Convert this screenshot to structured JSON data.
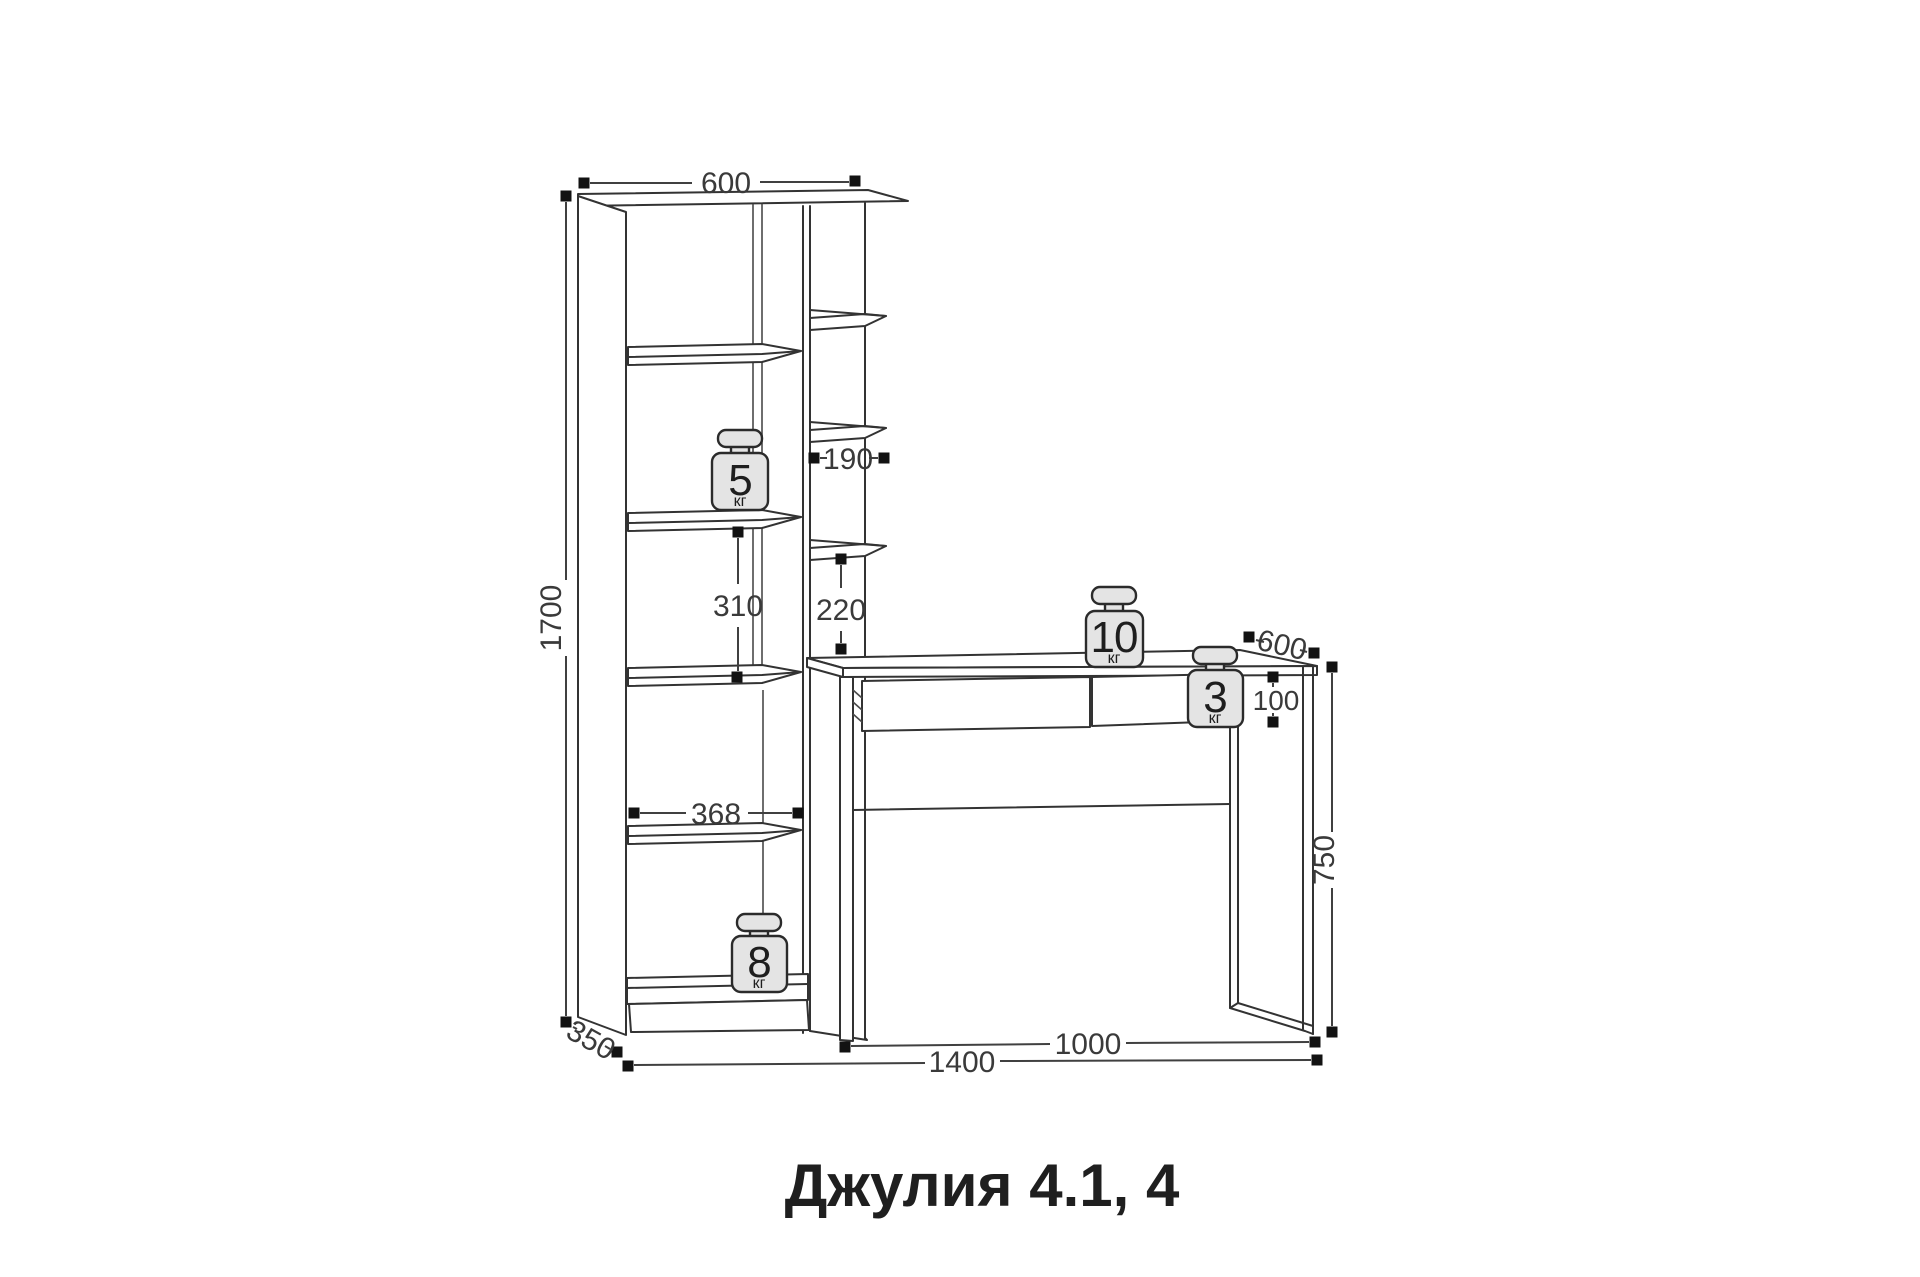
{
  "title": "Джулия 4.1, 4",
  "units": "мм",
  "dims": {
    "top_width": "600",
    "total_height": "1700",
    "column_inner_width": "190",
    "bay_shelf_spacing": "310",
    "column_shelf_spacing": "220",
    "bay_inner_width": "368",
    "desk_depth": "600",
    "drawer_height": "100",
    "desk_height": "750",
    "base_depth": "350",
    "total_width": "1400",
    "desk_width": "1000"
  },
  "loads": {
    "bay_shelf": {
      "value": "5",
      "unit": "кг"
    },
    "desktop": {
      "value": "10",
      "unit": "кг"
    },
    "desk_side": {
      "value": "3",
      "unit": "кг"
    },
    "bottom_shelf": {
      "value": "8",
      "unit": "кг"
    }
  }
}
